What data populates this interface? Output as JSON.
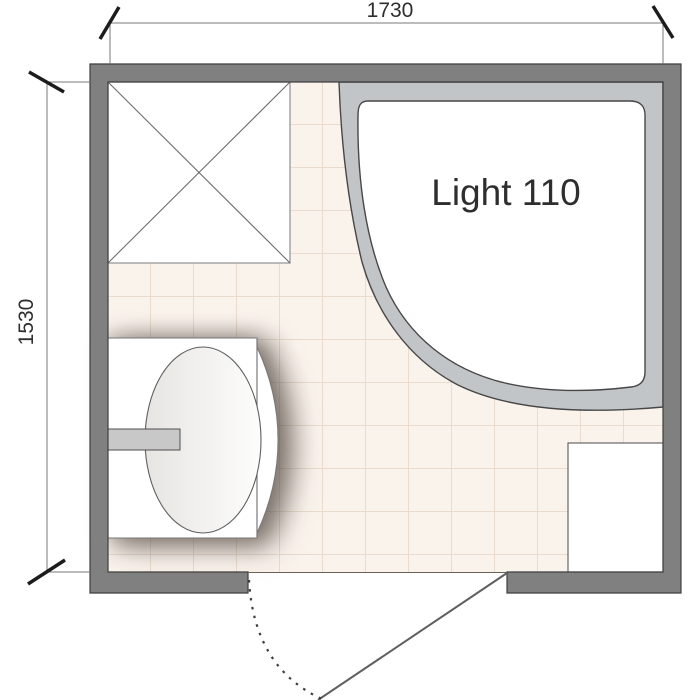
{
  "plan": {
    "dimensions": {
      "width_label": "1730",
      "height_label": "1530"
    },
    "fixtures": {
      "bathtub_label": "Light 110",
      "items": [
        "corner-bathtub",
        "shower-tray-placeholder-cross",
        "washbasin-with-faucet",
        "storage-niche",
        "door-with-swing-arc"
      ]
    },
    "colors": {
      "wall": "#808080",
      "wall_outline": "#3f3f3f",
      "tile": "#faf3ec",
      "grout": "#e9dccf",
      "bathtub_rim": "#c2c5c8",
      "fixture_fill": "#ffffff",
      "faucet": "#c8c8c8",
      "dimension_line": "#7a7a7a",
      "tick": "#1c1c1c",
      "text": "#2e2e2e"
    }
  }
}
